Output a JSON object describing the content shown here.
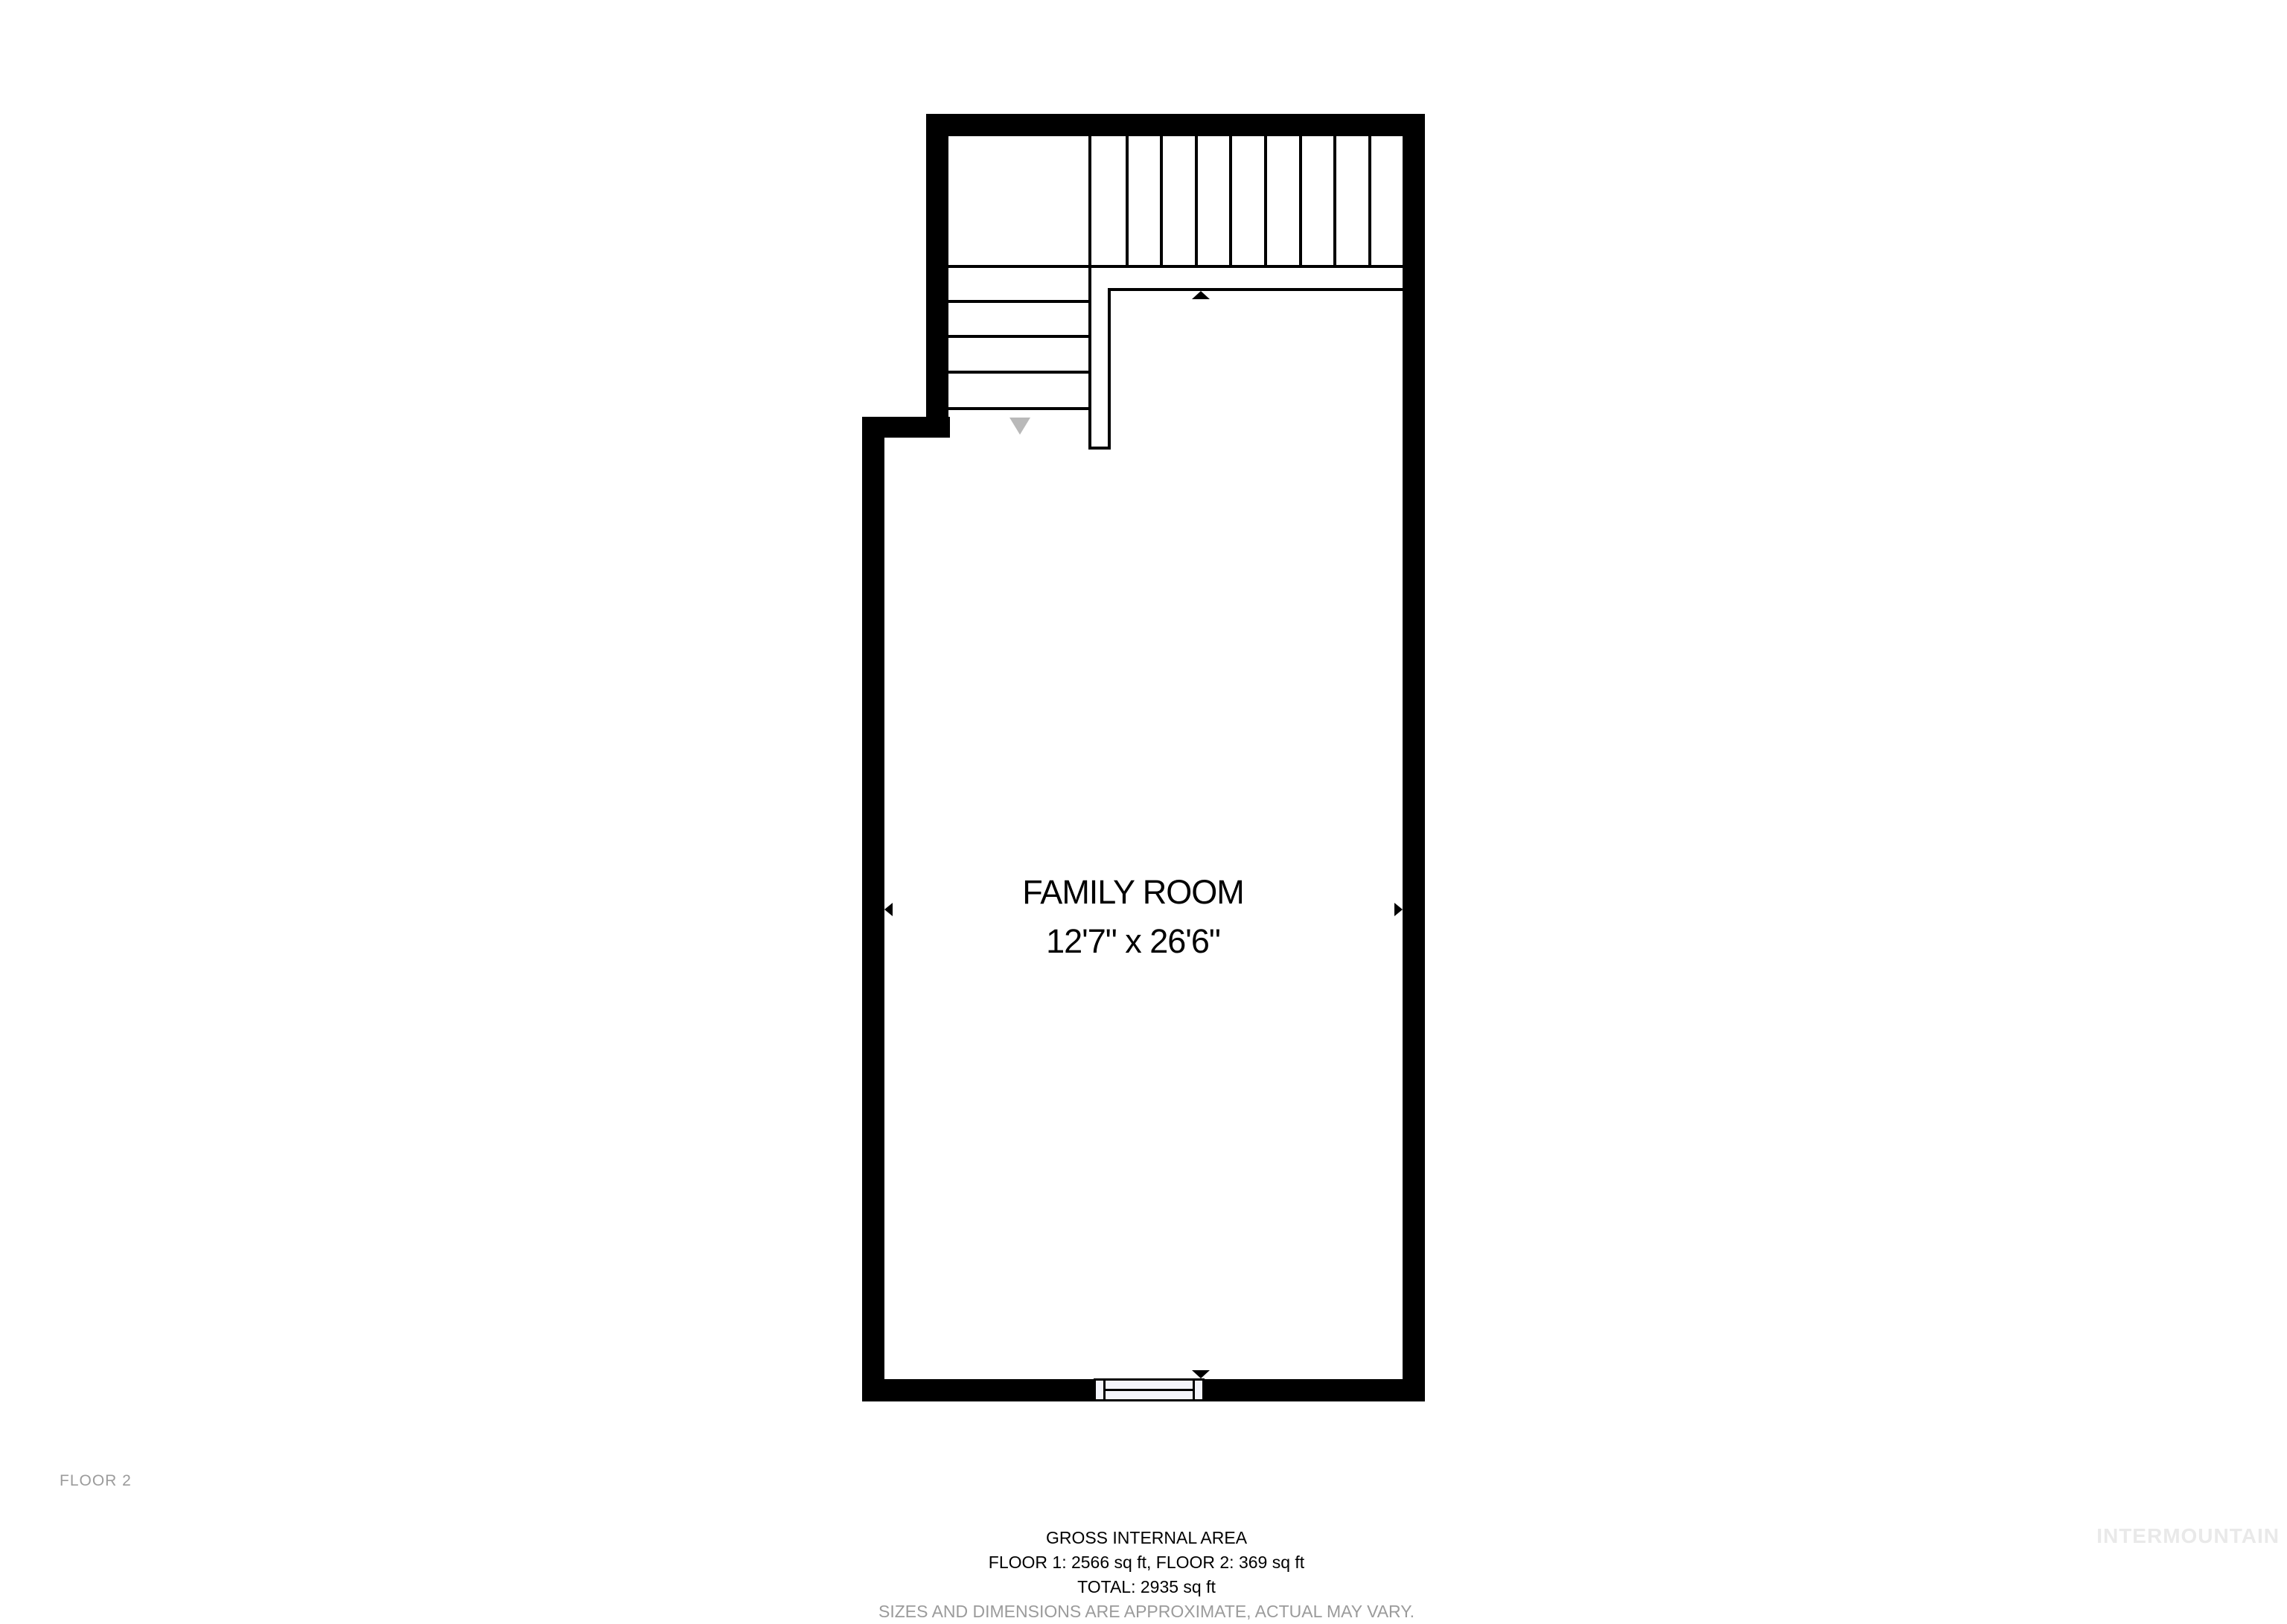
{
  "floor_label": "FLOOR 2",
  "room": {
    "name": "FAMILY ROOM",
    "dimensions": "12'7\" x 26'6\""
  },
  "footer": {
    "title": "GROSS INTERNAL AREA",
    "floors": "FLOOR 1: 2566 sq ft, FLOOR 2: 369 sq ft",
    "total": "TOTAL: 2935 sq ft",
    "disclaimer": "SIZES AND DIMENSIONS ARE APPROXIMATE, ACTUAL MAY VARY."
  },
  "watermark": "INTERMOUNTAIN",
  "icons": {
    "dimension_arrow_up": "black triangle pointing up (top of 26'6\" span)",
    "dimension_arrow_down": "black triangle pointing down (bottom of 26'6\" span)",
    "dimension_arrow_left": "black triangle pointing left (left of 12'7\" span)",
    "dimension_arrow_right": "black triangle pointing right (right of 12'7\" span)",
    "stair_direction_arrow": "gray triangle pointing down at bottom of staircase"
  },
  "colors": {
    "wall": "#000000",
    "line": "#000000",
    "text": "#000000",
    "muted_text": "#9b9b9b",
    "stair_arrow": "#b9b9b9",
    "watermark": "#e9e9e9",
    "window_fill": "#f4f5fb",
    "background": "#ffffff"
  }
}
